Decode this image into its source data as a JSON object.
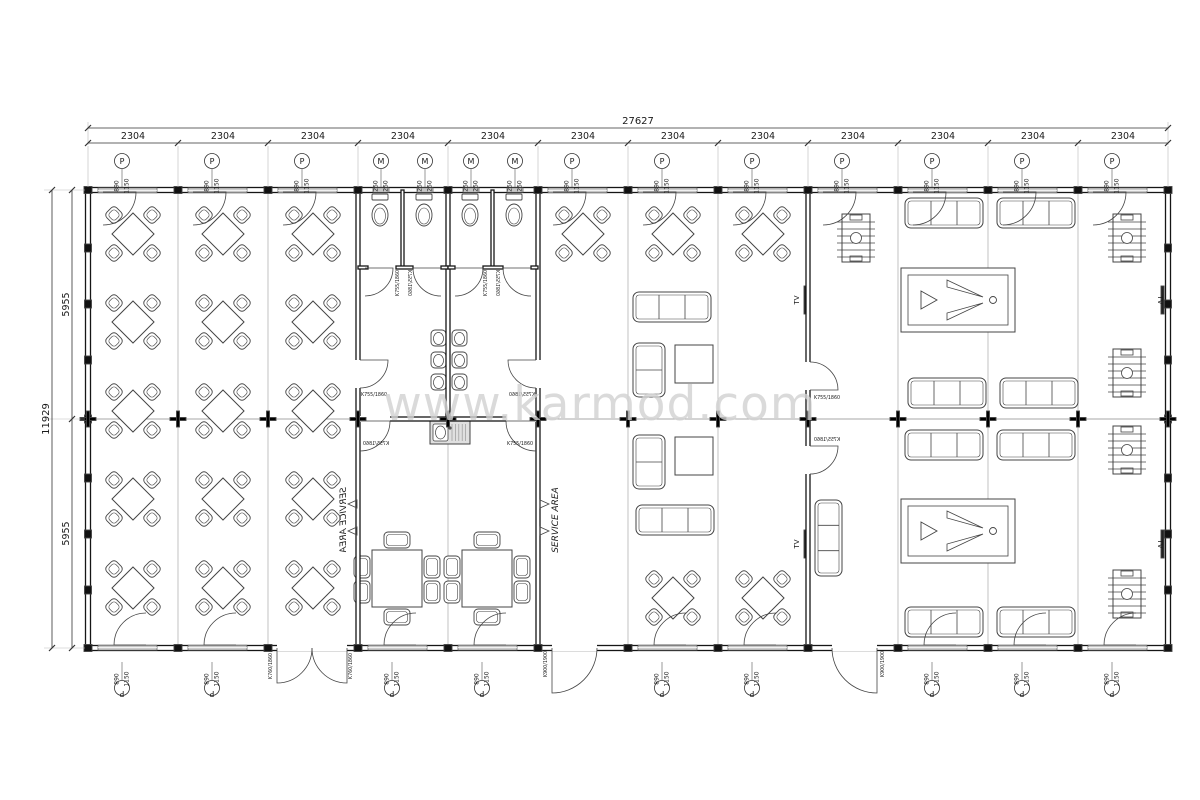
{
  "meta": {
    "type": "floor-plan",
    "watermark": "www.karmod.com"
  },
  "colors": {
    "paper": "#ffffff",
    "line": "#444444",
    "wall": "#161616",
    "grid": "#9a9a9a",
    "window_fill": "#c6c6c6",
    "text": "#1a1a1a",
    "watermark": "#d2d2d2",
    "ext_line": "#bbbbbb"
  },
  "dimensions": {
    "total_width_label": "27627",
    "total_height_label": "11929",
    "half_height_labels": [
      "5955",
      "5955"
    ],
    "column_labels": [
      "2304",
      "2304",
      "2304",
      "2304",
      "2304",
      "2304",
      "2304",
      "2304",
      "2304",
      "2304",
      "2304",
      "2304"
    ]
  },
  "window_marker": {
    "symbol": "P",
    "size_top": "890",
    "size_bottom": "1150"
  },
  "vent_marker": {
    "symbol": "M",
    "size_top": "250",
    "size_bottom": "250"
  },
  "door_labels": {
    "single": "K755/1860",
    "double": "K760/1860",
    "exterior": "K900/1900"
  },
  "room_labels": {
    "service_area": "SERVICE AREA",
    "tv": "TV"
  },
  "markers": {
    "top_p_x": [
      122,
      212,
      302,
      572,
      662,
      752,
      842,
      932,
      1022,
      1112
    ],
    "bottom_p_x": [
      122,
      212,
      392,
      482,
      662,
      752,
      932,
      1022,
      1112
    ],
    "m_x": [
      381,
      425,
      471,
      515
    ]
  },
  "furniture": {
    "dining_tables_4": [
      {
        "x": 133,
        "y": 234
      },
      {
        "x": 133,
        "y": 322
      },
      {
        "x": 133,
        "y": 411
      },
      {
        "x": 133,
        "y": 499
      },
      {
        "x": 133,
        "y": 588
      },
      {
        "x": 223,
        "y": 234
      },
      {
        "x": 223,
        "y": 322
      },
      {
        "x": 223,
        "y": 411
      },
      {
        "x": 223,
        "y": 499
      },
      {
        "x": 223,
        "y": 588
      },
      {
        "x": 313,
        "y": 234
      },
      {
        "x": 313,
        "y": 322
      },
      {
        "x": 313,
        "y": 411
      },
      {
        "x": 313,
        "y": 499
      },
      {
        "x": 313,
        "y": 588
      },
      {
        "x": 583,
        "y": 234
      },
      {
        "x": 673,
        "y": 234
      },
      {
        "x": 763,
        "y": 234
      },
      {
        "x": 673,
        "y": 598
      },
      {
        "x": 763,
        "y": 598
      }
    ],
    "service_tables_6": [
      {
        "x": 372,
        "y": 550
      },
      {
        "x": 462,
        "y": 550
      }
    ],
    "sofas_3_h": [
      {
        "x": 633,
        "y": 292
      },
      {
        "x": 636,
        "y": 505
      },
      {
        "x": 905,
        "y": 198
      },
      {
        "x": 997,
        "y": 198
      },
      {
        "x": 908,
        "y": 378
      },
      {
        "x": 1000,
        "y": 378
      },
      {
        "x": 905,
        "y": 430
      },
      {
        "x": 997,
        "y": 430
      },
      {
        "x": 905,
        "y": 607
      },
      {
        "x": 997,
        "y": 607
      }
    ],
    "sofas_2_v": [
      {
        "x": 633,
        "y": 343
      },
      {
        "x": 633,
        "y": 435
      }
    ],
    "sofas_3_v": [
      {
        "x": 815,
        "y": 500
      }
    ],
    "coffee_tables": [
      {
        "x": 675,
        "y": 345
      },
      {
        "x": 675,
        "y": 437
      }
    ],
    "pool_tables": [
      {
        "x": 901,
        "y": 268
      },
      {
        "x": 901,
        "y": 499
      }
    ],
    "foosball_tables": [
      {
        "x": 842,
        "y": 214
      },
      {
        "x": 1113,
        "y": 214
      },
      {
        "x": 1113,
        "y": 349
      },
      {
        "x": 1113,
        "y": 426
      },
      {
        "x": 1113,
        "y": 570
      }
    ],
    "toilets_cx": [
      380,
      424,
      470,
      514
    ],
    "washbasins": [
      {
        "x": 431,
        "y": 330
      },
      {
        "x": 431,
        "y": 352
      },
      {
        "x": 431,
        "y": 374
      },
      {
        "x": 452,
        "y": 330
      },
      {
        "x": 452,
        "y": 352
      },
      {
        "x": 452,
        "y": 374
      }
    ],
    "sink_counter": {
      "x": 430,
      "y": 421,
      "w": 40,
      "h": 23
    },
    "tv_units": [
      {
        "x": 804,
        "y": 286,
        "lx": 799,
        "ly": 300,
        "rot": -90
      },
      {
        "x": 804,
        "y": 530,
        "lx": 799,
        "ly": 544,
        "rot": -90
      },
      {
        "x": 1161,
        "y": 286,
        "lx": 1158,
        "ly": 300,
        "rot": 90
      },
      {
        "x": 1161,
        "y": 530,
        "lx": 1158,
        "ly": 544,
        "rot": 90
      }
    ]
  },
  "doors": {
    "swings": [
      {
        "hx": 103,
        "hy": 192,
        "r": 33,
        "a0": 0,
        "a1": 90
      },
      {
        "hx": 193,
        "hy": 192,
        "r": 33,
        "a0": 0,
        "a1": 90
      },
      {
        "hx": 283,
        "hy": 192,
        "r": 33,
        "a0": 0,
        "a1": 90
      },
      {
        "hx": 553,
        "hy": 192,
        "r": 33,
        "a0": 0,
        "a1": 90
      },
      {
        "hx": 643,
        "hy": 192,
        "r": 33,
        "a0": 0,
        "a1": 90
      },
      {
        "hx": 733,
        "hy": 192,
        "r": 33,
        "a0": 0,
        "a1": 90
      },
      {
        "hx": 823,
        "hy": 192,
        "r": 33,
        "a0": 0,
        "a1": 90
      },
      {
        "hx": 913,
        "hy": 192,
        "r": 33,
        "a0": 0,
        "a1": 90
      },
      {
        "hx": 1003,
        "hy": 192,
        "r": 33,
        "a0": 0,
        "a1": 90
      },
      {
        "hx": 1093,
        "hy": 192,
        "r": 33,
        "a0": 0,
        "a1": 90
      },
      {
        "hx": 146,
        "hy": 645,
        "r": 32,
        "a0": 180,
        "a1": 270
      },
      {
        "hx": 236,
        "hy": 645,
        "r": 32,
        "a0": 180,
        "a1": 270
      },
      {
        "hx": 416,
        "hy": 645,
        "r": 32,
        "a0": 180,
        "a1": 270
      },
      {
        "hx": 506,
        "hy": 645,
        "r": 32,
        "a0": 180,
        "a1": 270
      },
      {
        "hx": 686,
        "hy": 645,
        "r": 32,
        "a0": 180,
        "a1": 270
      },
      {
        "hx": 776,
        "hy": 645,
        "r": 32,
        "a0": 180,
        "a1": 270
      },
      {
        "hx": 956,
        "hy": 645,
        "r": 32,
        "a0": 180,
        "a1": 270
      },
      {
        "hx": 1046,
        "hy": 645,
        "r": 32,
        "a0": 180,
        "a1": 270
      },
      {
        "hx": 1136,
        "hy": 645,
        "r": 32,
        "a0": 180,
        "a1": 270
      },
      {
        "hx": 277,
        "hy": 648,
        "r": 35,
        "a0": 90,
        "a1": 0
      },
      {
        "hx": 347,
        "hy": 648,
        "r": 35,
        "a0": 90,
        "a1": 180
      },
      {
        "hx": 552,
        "hy": 648,
        "r": 45,
        "a0": 90,
        "a1": 0
      },
      {
        "hx": 877,
        "hy": 648,
        "r": 45,
        "a0": 90,
        "a1": 180
      },
      {
        "hx": 365,
        "hy": 268,
        "r": 28,
        "a0": 0,
        "a1": 90
      },
      {
        "hx": 441,
        "hy": 268,
        "r": 28,
        "a0": 180,
        "a1": 90
      },
      {
        "hx": 455,
        "hy": 268,
        "r": 28,
        "a0": 0,
        "a1": 90
      },
      {
        "hx": 531,
        "hy": 268,
        "r": 28,
        "a0": 180,
        "a1": 90
      },
      {
        "hx": 360,
        "hy": 360,
        "r": 28,
        "a0": 0,
        "a1": 90
      },
      {
        "hx": 536,
        "hy": 360,
        "r": 28,
        "a0": 180,
        "a1": 90
      },
      {
        "hx": 360,
        "hy": 421,
        "r": 30,
        "a0": 0,
        "a1": 90
      },
      {
        "hx": 536,
        "hy": 421,
        "r": 30,
        "a0": 180,
        "a1": 90
      },
      {
        "hx": 810,
        "hy": 390,
        "r": 28,
        "a0": 0,
        "a1": -90
      },
      {
        "hx": 810,
        "hy": 446,
        "r": 28,
        "a0": 0,
        "a1": 90
      }
    ],
    "labels": [
      {
        "x": 272,
        "y": 666,
        "rot": -90,
        "key": "double"
      },
      {
        "x": 352,
        "y": 666,
        "rot": -90,
        "key": "double"
      },
      {
        "x": 547,
        "y": 664,
        "rot": -90,
        "key": "exterior"
      },
      {
        "x": 884,
        "y": 664,
        "rot": -90,
        "key": "exterior"
      },
      {
        "x": 399,
        "y": 283,
        "rot": -90,
        "key": "single"
      },
      {
        "x": 412,
        "y": 283,
        "rot": -90,
        "mirror": true,
        "key": "single"
      },
      {
        "x": 487,
        "y": 283,
        "rot": -90,
        "key": "single"
      },
      {
        "x": 500,
        "y": 283,
        "rot": -90,
        "mirror": true,
        "key": "single"
      },
      {
        "x": 374,
        "y": 396,
        "rot": 0,
        "key": "single"
      },
      {
        "x": 522,
        "y": 396,
        "rot": 0,
        "mirror": true,
        "key": "single"
      },
      {
        "x": 376,
        "y": 445,
        "rot": 0,
        "mirror": true,
        "key": "single"
      },
      {
        "x": 520,
        "y": 445,
        "rot": 0,
        "key": "single"
      },
      {
        "x": 827,
        "y": 399,
        "rot": 0,
        "key": "single"
      },
      {
        "x": 827,
        "y": 441,
        "rot": 0,
        "mirror": true,
        "key": "single"
      }
    ],
    "openings": [
      {
        "x": 277,
        "y": 644,
        "w": 70,
        "h": 7
      },
      {
        "x": 552,
        "y": 644,
        "w": 45,
        "h": 7
      },
      {
        "x": 832,
        "y": 644,
        "w": 45,
        "h": 7
      },
      {
        "x": 805,
        "y": 362,
        "w": 6,
        "h": 28
      },
      {
        "x": 805,
        "y": 446,
        "w": 6,
        "h": 28
      },
      {
        "x": 355,
        "y": 360,
        "w": 6,
        "h": 28
      },
      {
        "x": 535,
        "y": 360,
        "w": 6,
        "h": 28
      },
      {
        "x": 360,
        "y": 416,
        "w": 30,
        "h": 6
      },
      {
        "x": 506,
        "y": 416,
        "w": 30,
        "h": 6
      }
    ]
  },
  "service_area_labels": [
    {
      "x": 346,
      "y": 520,
      "mirror": true
    },
    {
      "x": 558,
      "y": 520,
      "mirror": false
    }
  ],
  "service_area_arrows": [
    {
      "x": 350,
      "y": 504,
      "dir": "left"
    },
    {
      "x": 350,
      "y": 531,
      "dir": "left"
    },
    {
      "x": 547,
      "y": 504,
      "dir": "right"
    },
    {
      "x": 547,
      "y": 531,
      "dir": "right"
    }
  ]
}
